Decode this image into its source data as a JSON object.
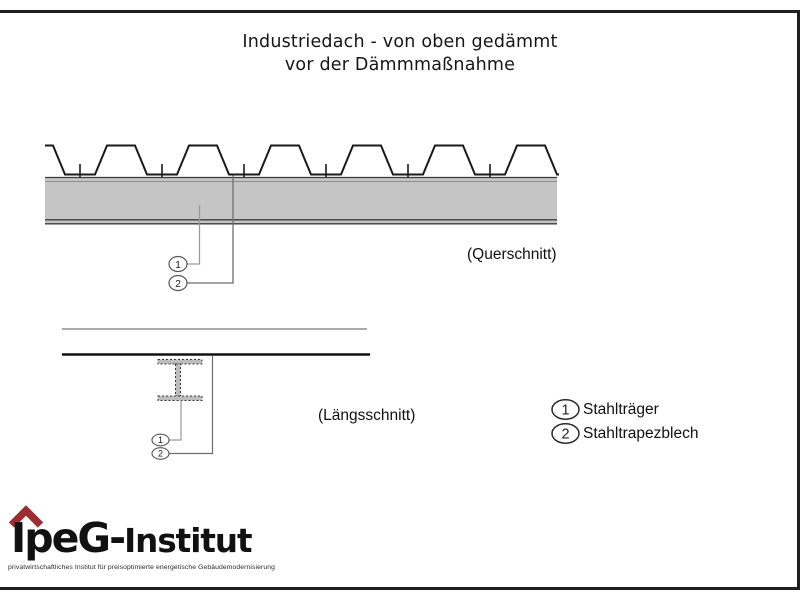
{
  "page": {
    "title_line1": "Industriedach - von oben gedämmt",
    "title_line2": "vor der Dämmmaßnahme"
  },
  "sections": {
    "cross_section_caption": "(Querschnitt)",
    "long_section_caption": "(Längsschnitt)"
  },
  "markers": {
    "m1": "1",
    "m2": "2"
  },
  "legend": {
    "items": [
      {
        "number": "1",
        "label": "Stahlträger"
      },
      {
        "number": "2",
        "label": "Stahltrapezblech"
      }
    ]
  },
  "logo": {
    "brand_main": "IpeG-",
    "brand_rest": "Institut",
    "tagline": "privatwirtschaftliches Institut für preisoptimierte energetische Gebäudemodernisierung"
  },
  "colors": {
    "accent_red": "#9b2d33",
    "beam_gray": "#c5c5c5",
    "line_black": "#1a1a1a"
  }
}
